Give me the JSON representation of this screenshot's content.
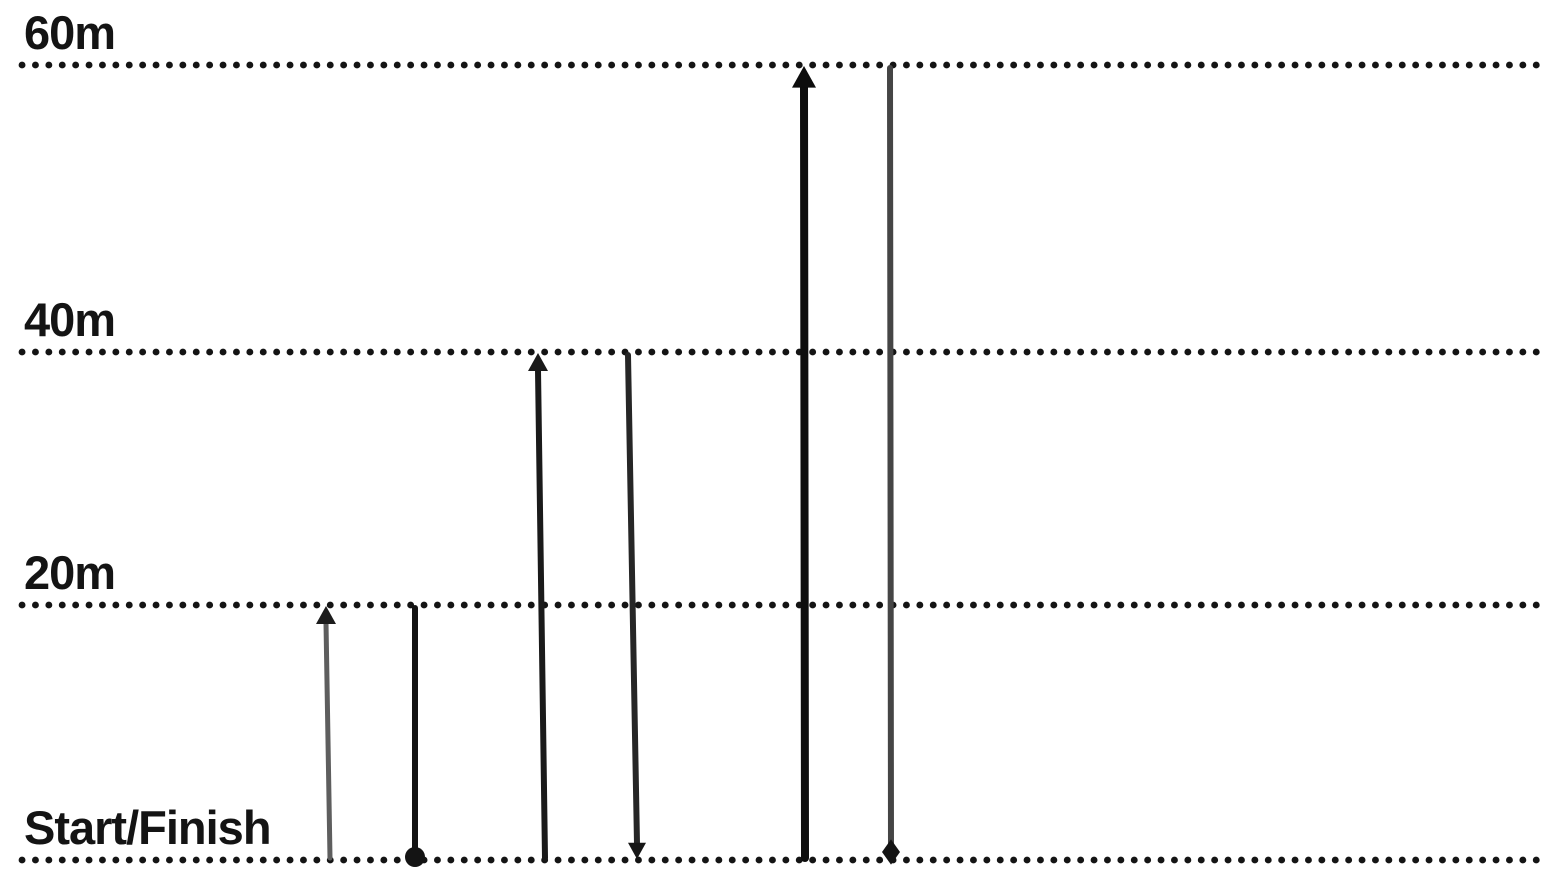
{
  "diagram": {
    "type": "shuttle-run-course",
    "background": "#ffffff",
    "dot_color": "#141414",
    "dot_size": 6.8,
    "dot_gap": 13.3,
    "line_x_start": 22,
    "line_x_end": 1548,
    "label_color": "#141414",
    "levels": [
      {
        "id": "m60",
        "label": "60m",
        "distance_m": 60,
        "y": 65
      },
      {
        "id": "m40",
        "label": "40m",
        "distance_m": 40,
        "y": 352
      },
      {
        "id": "m20",
        "label": "20m",
        "distance_m": 20,
        "y": 605
      },
      {
        "id": "start",
        "label": "Start/Finish",
        "distance_m": 0,
        "y": 860
      }
    ],
    "arrows": [
      {
        "name": "run-1-out",
        "from": "start",
        "to": "m20",
        "direction": "up",
        "x_from": 330,
        "x_to": 326,
        "color": "#5e5e5e",
        "width": 5,
        "head_type": "triangle",
        "head_size": 10,
        "head_color": "#1c1c1c"
      },
      {
        "name": "run-1-back",
        "from": "m20",
        "to": "start",
        "direction": "down",
        "x_from": 415,
        "x_to": 415,
        "color": "#141414",
        "width": 6,
        "head_type": "dot",
        "head_size": 10,
        "head_color": "#141414"
      },
      {
        "name": "run-2-out",
        "from": "start",
        "to": "m40",
        "direction": "up",
        "x_from": 545,
        "x_to": 538,
        "color": "#1a1a1a",
        "width": 6,
        "head_type": "triangle",
        "head_size": 10,
        "head_color": "#1a1a1a"
      },
      {
        "name": "run-2-back",
        "from": "m40",
        "to": "start",
        "direction": "down",
        "x_from": 628,
        "x_to": 637,
        "color": "#262626",
        "width": 6,
        "head_type": "triangle",
        "head_size": 9,
        "head_color": "#161616"
      },
      {
        "name": "run-3-out",
        "from": "start",
        "to": "m60",
        "direction": "up",
        "x_from": 805,
        "x_to": 804,
        "color": "#0d0d0d",
        "width": 8,
        "head_type": "triangle",
        "head_size": 12,
        "head_color": "#0d0d0d"
      },
      {
        "name": "run-3-back",
        "from": "m60",
        "to": "start",
        "direction": "down",
        "x_from": 890,
        "x_to": 891,
        "color": "#454545",
        "width": 6,
        "head_type": "diamond",
        "head_size": 9,
        "head_color": "#141414"
      }
    ]
  }
}
